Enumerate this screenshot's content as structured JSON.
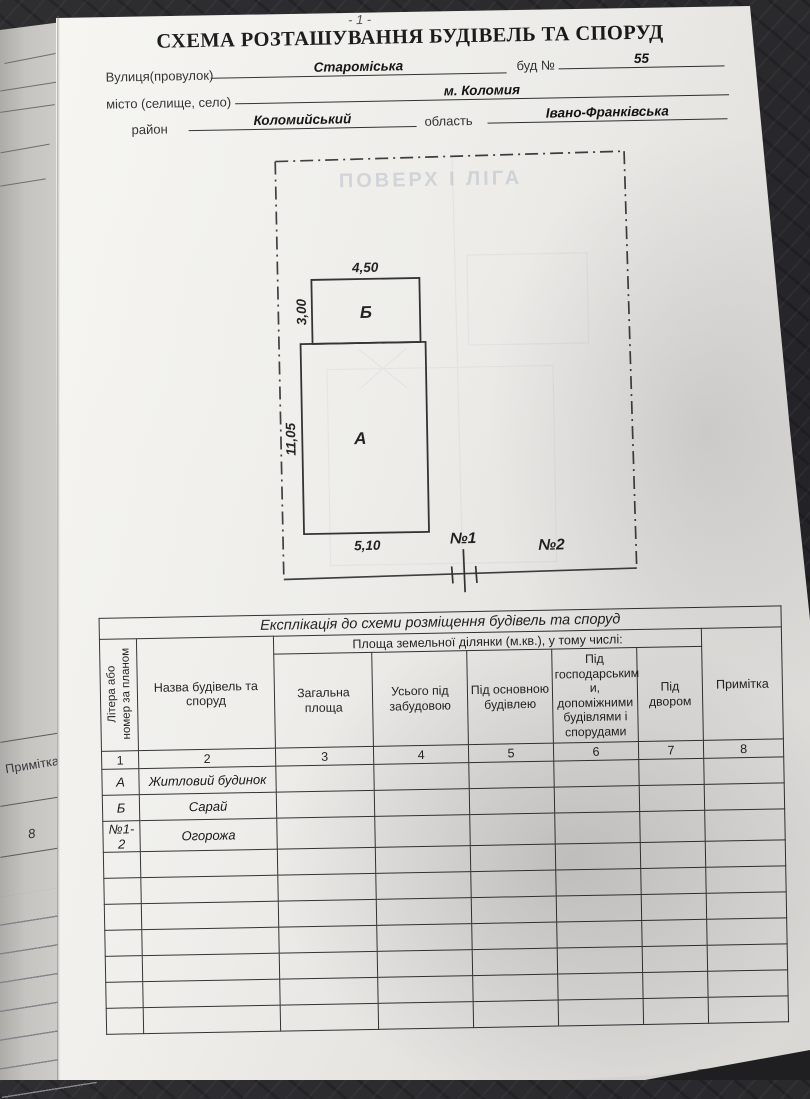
{
  "page_number": "- 1 -",
  "title": "СХЕМА РОЗТАШУВАННЯ БУДІВЕЛЬ ТА СПОРУД",
  "form": {
    "street_label": "Вулиця(провулок)",
    "street_value": "Староміська",
    "building_no_label": "буд №",
    "building_no_value": "55",
    "city_label": "місто (селище, село)",
    "city_value": "м. Коломия",
    "district_label": "район",
    "district_value": "Коломийський",
    "region_label": "область",
    "region_value": "Івано-Франківська"
  },
  "plan": {
    "ghost_bleed_text": "ПОВЕРХ І ЛІГА",
    "building_b": {
      "label": "Б",
      "width_dim": "4,50",
      "height_dim": "3,00"
    },
    "building_a": {
      "label": "А",
      "height_dim": "11,05",
      "width_dim": "5,10"
    },
    "fence_label_1": "№1",
    "fence_label_2": "№2"
  },
  "table": {
    "title": "Експлікація до схеми розміщення будівель та споруд",
    "area_group_header": "Площа земельної ділянки (м.кв.), у тому числі:",
    "columns": [
      "Літера або номер за планом",
      "Назва будівель та споруд",
      "Загальна площа",
      "Усього під забудовою",
      "Під основною будівлею",
      "Під господарським и, допоміжними будівлями і спорудами",
      "Під двором",
      "Примітка"
    ],
    "column_numbers": [
      "1",
      "2",
      "3",
      "4",
      "5",
      "6",
      "7",
      "8"
    ],
    "rows": [
      {
        "letter": "А",
        "name": "Житловий будинок",
        "c3": "",
        "c4": "",
        "c5": "",
        "c6": "",
        "c7": "",
        "c8": ""
      },
      {
        "letter": "Б",
        "name": "Сарай",
        "c3": "",
        "c4": "",
        "c5": "",
        "c6": "",
        "c7": "",
        "c8": ""
      },
      {
        "letter": "№1-2",
        "name": "Огорожа",
        "c3": "",
        "c4": "",
        "c5": "",
        "c6": "",
        "c7": "",
        "c8": ""
      }
    ],
    "empty_row_count": 7
  },
  "underlying_page": {
    "note_label": "Примітка",
    "page_edge_number": "8"
  },
  "colors": {
    "paper": "#f3f2ee",
    "ink": "#1b1b1b",
    "background": "#26262a",
    "under_page": "#cbc9c5",
    "ghost": "#bfc6cf"
  }
}
